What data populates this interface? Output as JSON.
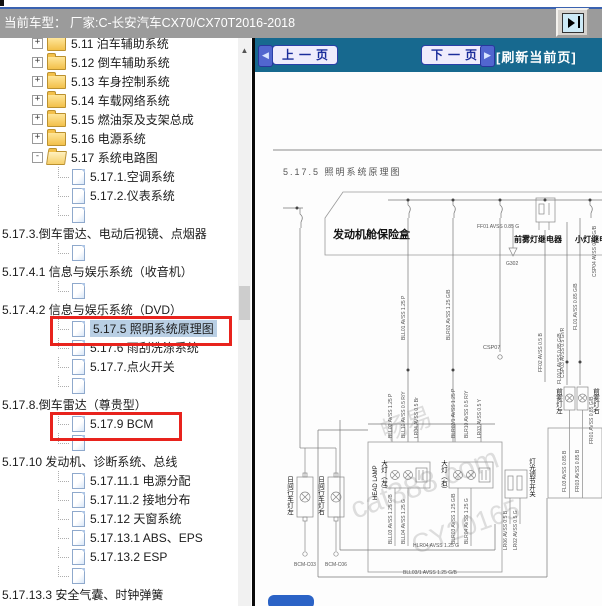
{
  "colors": {
    "header_teal": "#17698f",
    "selection_blue": "#b9cfe4",
    "highlight_red": "#e8231d",
    "titlebar_gray": "#9b9b9b",
    "button_blue": "#2b63c6"
  },
  "titlebar": {
    "label": "当前车型：  厂家:C-长安汽车CX70/CX70T2016-2018"
  },
  "tree": {
    "plus_glyph": "+",
    "minus_glyph": "-",
    "scroll_up_glyph": "▲",
    "items": [
      {
        "label": "5.11 泊车辅助系统",
        "type": "folder"
      },
      {
        "label": "5.12 倒车辅助系统",
        "type": "folder"
      },
      {
        "label": "5.13 车身控制系统",
        "type": "folder"
      },
      {
        "label": "5.14 车载网络系统",
        "type": "folder"
      },
      {
        "label": "5.15 燃油泵及支架总成",
        "type": "folder"
      },
      {
        "label": "5.16 电源系统",
        "type": "folder"
      },
      {
        "label": "5.17 系统电路图",
        "type": "folder-open"
      },
      {
        "label": "5.17.1.空调系统",
        "type": "doc"
      },
      {
        "label": "5.17.2.仪表系统",
        "type": "doc"
      },
      {
        "label": "",
        "type": "doc-blank"
      },
      {
        "label": "5.17.3.倒车雷达、电动后视镜、点烟器",
        "type": "long"
      },
      {
        "label": "",
        "type": "doc-blank"
      },
      {
        "label": "5.17.4.1 信息与娱乐系统（收音机）",
        "type": "long"
      },
      {
        "label": "",
        "type": "doc-blank"
      },
      {
        "label": "5.17.4.2 信息与娱乐系统（DVD）",
        "type": "long"
      },
      {
        "label": "5.17.5 照明系统原理图",
        "type": "doc",
        "selected": true,
        "highlighted": true
      },
      {
        "label": "5.17.6 雨刮洗涤系统",
        "type": "doc"
      },
      {
        "label": "5.17.7.点火开关",
        "type": "doc"
      },
      {
        "label": "",
        "type": "doc-blank"
      },
      {
        "label": "5.17.8.倒车雷达（尊贵型）",
        "type": "long"
      },
      {
        "label": "5.17.9 BCM",
        "type": "doc",
        "highlighted": true
      },
      {
        "label": "",
        "type": "doc-blank"
      },
      {
        "label": "5.17.10 发动机、诊断系统、总线",
        "type": "long"
      },
      {
        "label": "5.17.11.1 电源分配",
        "type": "doc"
      },
      {
        "label": "5.17.11.2 接地分布",
        "type": "doc"
      },
      {
        "label": "5.17.12 天窗系统",
        "type": "doc"
      },
      {
        "label": "5.17.13.1 ABS、EPS",
        "type": "doc"
      },
      {
        "label": "5.17.13.2 ESP",
        "type": "doc"
      },
      {
        "label": "",
        "type": "doc-blank"
      },
      {
        "label": "5.17.13.3 安全气囊、时钟弹簧",
        "type": "long"
      }
    ]
  },
  "viewer": {
    "prev_label": "上一页",
    "next_label": "下一页",
    "prev_icon": "◀",
    "next_icon": "▶",
    "refresh_label": "[刷新当前页]",
    "diagram": {
      "title": "5.17.5 照明系统原理图",
      "fusebox_label": "发动机舱保险盒",
      "fog_relay_label": "前雾灯继电器",
      "small_lamp_relay_label": "小灯继电器",
      "ground_label": "G302",
      "connector_label": "CSP07",
      "fog_left_label": "前雾灯左",
      "fog_right_label": "前雾灯右",
      "drl_left_label": "日间行车灯左",
      "drl_right_label": "日间行车灯右",
      "bcm_c03_label": "BCM-C03",
      "bcm_c06_label": "BCM-C06",
      "headlamp_en_label": "HEAD LAMP",
      "headlamp_left_label": "大灯（左）",
      "headlamp_right_label": "大灯（右）",
      "light_switch_label": "灯光调节开关",
      "wires": {
        "ff01": "FF01 AVSS 0.85 G",
        "bll01": "BLL01 AVSS 1.25 P",
        "blr02": "BLR02 AVSS 1.25 G/B",
        "ff02": "FF02 AVSS 0.5 B",
        "csp03": "CSP03 AVSS 0.5 Gr/R",
        "csp04": "CSP04 AVSS 0.85 G/B",
        "fl01": "FL01 AVSS 0.85 G/B",
        "fl011": "FL01/1 AVSS 0.85 G/B",
        "fr01": "FR01 AVSS 0.85 G/B",
        "fl03": "FL03 AVSS 0.85 B",
        "fr03": "FR03 AVSS 0.85 B",
        "bll02": "BLL02 AVSS 1.25 P",
        "bll10": "BLL10 AVSS 0.5 R/Y",
        "lr04": "LR04 AVSS 0.5 Br",
        "blr021": "BLR02/1 AVSS 1.25 P",
        "blr10": "BLR10 AVSS 0.5 R/Y",
        "lr03": "LR03 AVSS 0.5 Y",
        "lr06": "LR06 AVSS 0.5 B",
        "lr02": "LR02 AVSS 0.5 G",
        "bll03": "BLL03 AVSS 1.25 G/B",
        "bll04": "BLL04 AVSS 1.25 G",
        "blr03": "BLR03 AVSS 1.25 G/B",
        "blr04": "BLR04 AVSS 1.25 G",
        "hlr04": "HLR04 AVSS 1.25 G",
        "bll031": "BLL03/1 AVSS 1.25 G/B"
      },
      "watermark": {
        "line1": "畅易",
        "line2": "cat388.com",
        "line3": "CY20165"
      }
    }
  }
}
